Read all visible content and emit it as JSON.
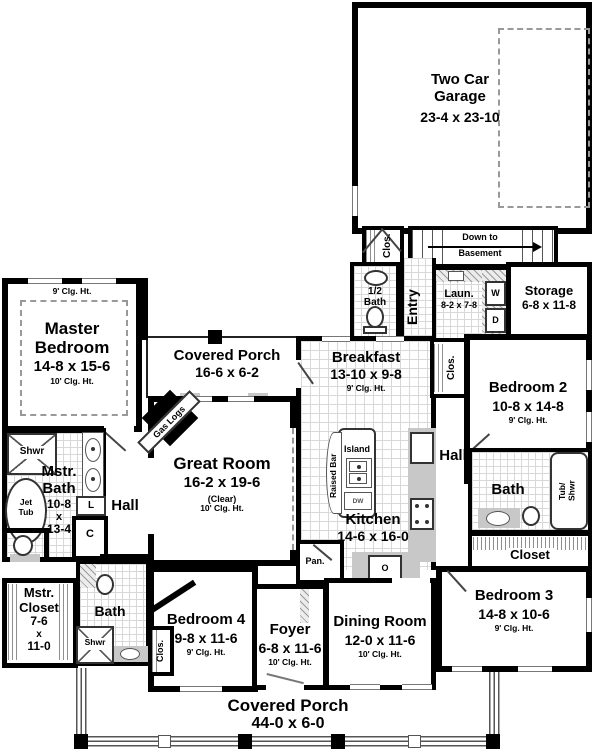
{
  "rooms": {
    "garage": {
      "name1": "Two Car",
      "name2": "Garage",
      "dims": "23-4 x 23-10"
    },
    "stairs": {
      "line1": "Down to",
      "line2": "Basement"
    },
    "entry_closet": {
      "label": "Clos."
    },
    "half_bath": {
      "line1": "1/2",
      "line2": "Bath"
    },
    "entry": {
      "label": "Entry"
    },
    "laundry": {
      "name": "Laun.",
      "dims": "8-2 x 7-8"
    },
    "washer": {
      "label": "W"
    },
    "dryer": {
      "label": "D"
    },
    "storage": {
      "name": "Storage",
      "dims": "6-8 x 11-8"
    },
    "master_bedroom": {
      "clg_9": "9' Clg. Ht.",
      "name1": "Master",
      "name2": "Bedroom",
      "dims": "14-8 x 15-6",
      "clg_10": "10' Clg. Ht."
    },
    "rear_porch": {
      "name": "Covered Porch",
      "dims": "16-6 x 6-2"
    },
    "fireplace": {
      "label": "Gas Logs"
    },
    "great_room": {
      "name": "Great Room",
      "dims": "16-2 x 19-6",
      "note": "(Clear)",
      "clg": "10' Clg. Ht."
    },
    "breakfast": {
      "name": "Breakfast",
      "dims": "13-10 x 9-8",
      "clg": "9' Clg. Ht."
    },
    "bedroom2_closet": {
      "label": "Clos."
    },
    "bedroom2": {
      "name": "Bedroom 2",
      "dims": "10-8 x 14-8",
      "clg": "9' Clg. Ht."
    },
    "hall_right": {
      "label": "Hall"
    },
    "hall_left": {
      "label": "Hall"
    },
    "island": {
      "label": "Island",
      "bar": "Raised Bar",
      "dw": "DW"
    },
    "kitchen": {
      "name": "Kitchen",
      "dims": "14-6 x 16-0"
    },
    "pantry": {
      "label": "Pan."
    },
    "oven": {
      "label": "O"
    },
    "bath2": {
      "name": "Bath",
      "tub1": "Tub/",
      "tub2": "Shwr"
    },
    "closet2": {
      "label": "Closet"
    },
    "bedroom3": {
      "name": "Bedroom 3",
      "dims": "14-8 x 10-6",
      "clg": "9' Clg. Ht."
    },
    "master_bath": {
      "shwr": "Shwr",
      "jet1": "Jet",
      "jet2": "Tub",
      "name1": "Mstr.",
      "name2": "Bath",
      "d1": "10-8",
      "d2": "x",
      "d3": "13-4",
      "linen": "L",
      "closet": "C"
    },
    "master_closet": {
      "name1": "Mstr.",
      "name2": "Closet",
      "d1": "7-6",
      "d2": "x",
      "d3": "11-0"
    },
    "bath4": {
      "name": "Bath",
      "shwr": "Shwr"
    },
    "bedroom4_closet": {
      "label": "Clos."
    },
    "bedroom4": {
      "name": "Bedroom 4",
      "dims": "9-8 x 11-6",
      "clg": "9' Clg. Ht."
    },
    "foyer": {
      "name": "Foyer",
      "dims": "6-8 x 11-6",
      "clg": "10' Clg. Ht."
    },
    "dining": {
      "name": "Dining Room",
      "dims": "12-0 x 11-6",
      "clg": "10' Clg. Ht."
    },
    "front_porch": {
      "name": "Covered Porch",
      "dims": "44-0 x 6-0"
    }
  },
  "colors": {
    "wall": "#000000",
    "tile_line": "#d8d8d8",
    "counter": "#c8c8c8",
    "dashed": "#999999"
  }
}
